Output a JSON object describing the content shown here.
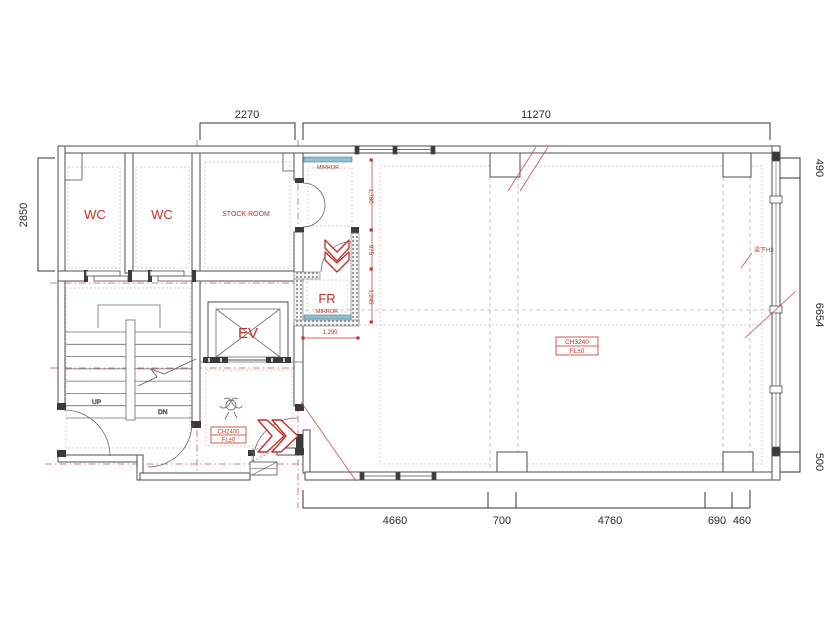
{
  "colors": {
    "red": "#bf3128",
    "teal": "#8fc0d0",
    "wall_line": "#4d4d4d",
    "dim_line": "#333333",
    "pink_dash": "#dfb4b0",
    "gray_dash": "#b8b8b8"
  },
  "dims": {
    "top": [
      "2270",
      "11270"
    ],
    "left": "2850",
    "right": [
      "490",
      "6654",
      "500"
    ],
    "bottom": [
      "4660",
      "700",
      "4760",
      "690",
      "460"
    ],
    "fitting": [
      "1,780",
      "975",
      "1,245"
    ],
    "fitting_width": "1,290"
  },
  "rooms": {
    "wc1": "WC",
    "wc2": "WC",
    "stock": "STOCK ROOM",
    "fitting": "FR",
    "elevator": "EV"
  },
  "labels": {
    "mirror_top": "MIRROR",
    "mirror_fitting": "MIRROR",
    "up": "UP",
    "down": "DN",
    "beam_note": "梁下H3"
  },
  "tags": {
    "entrance": {
      "ch": "CH2400",
      "fl": "FL±0"
    },
    "hall": {
      "ch": "CH3240",
      "fl": "FL±0"
    }
  }
}
